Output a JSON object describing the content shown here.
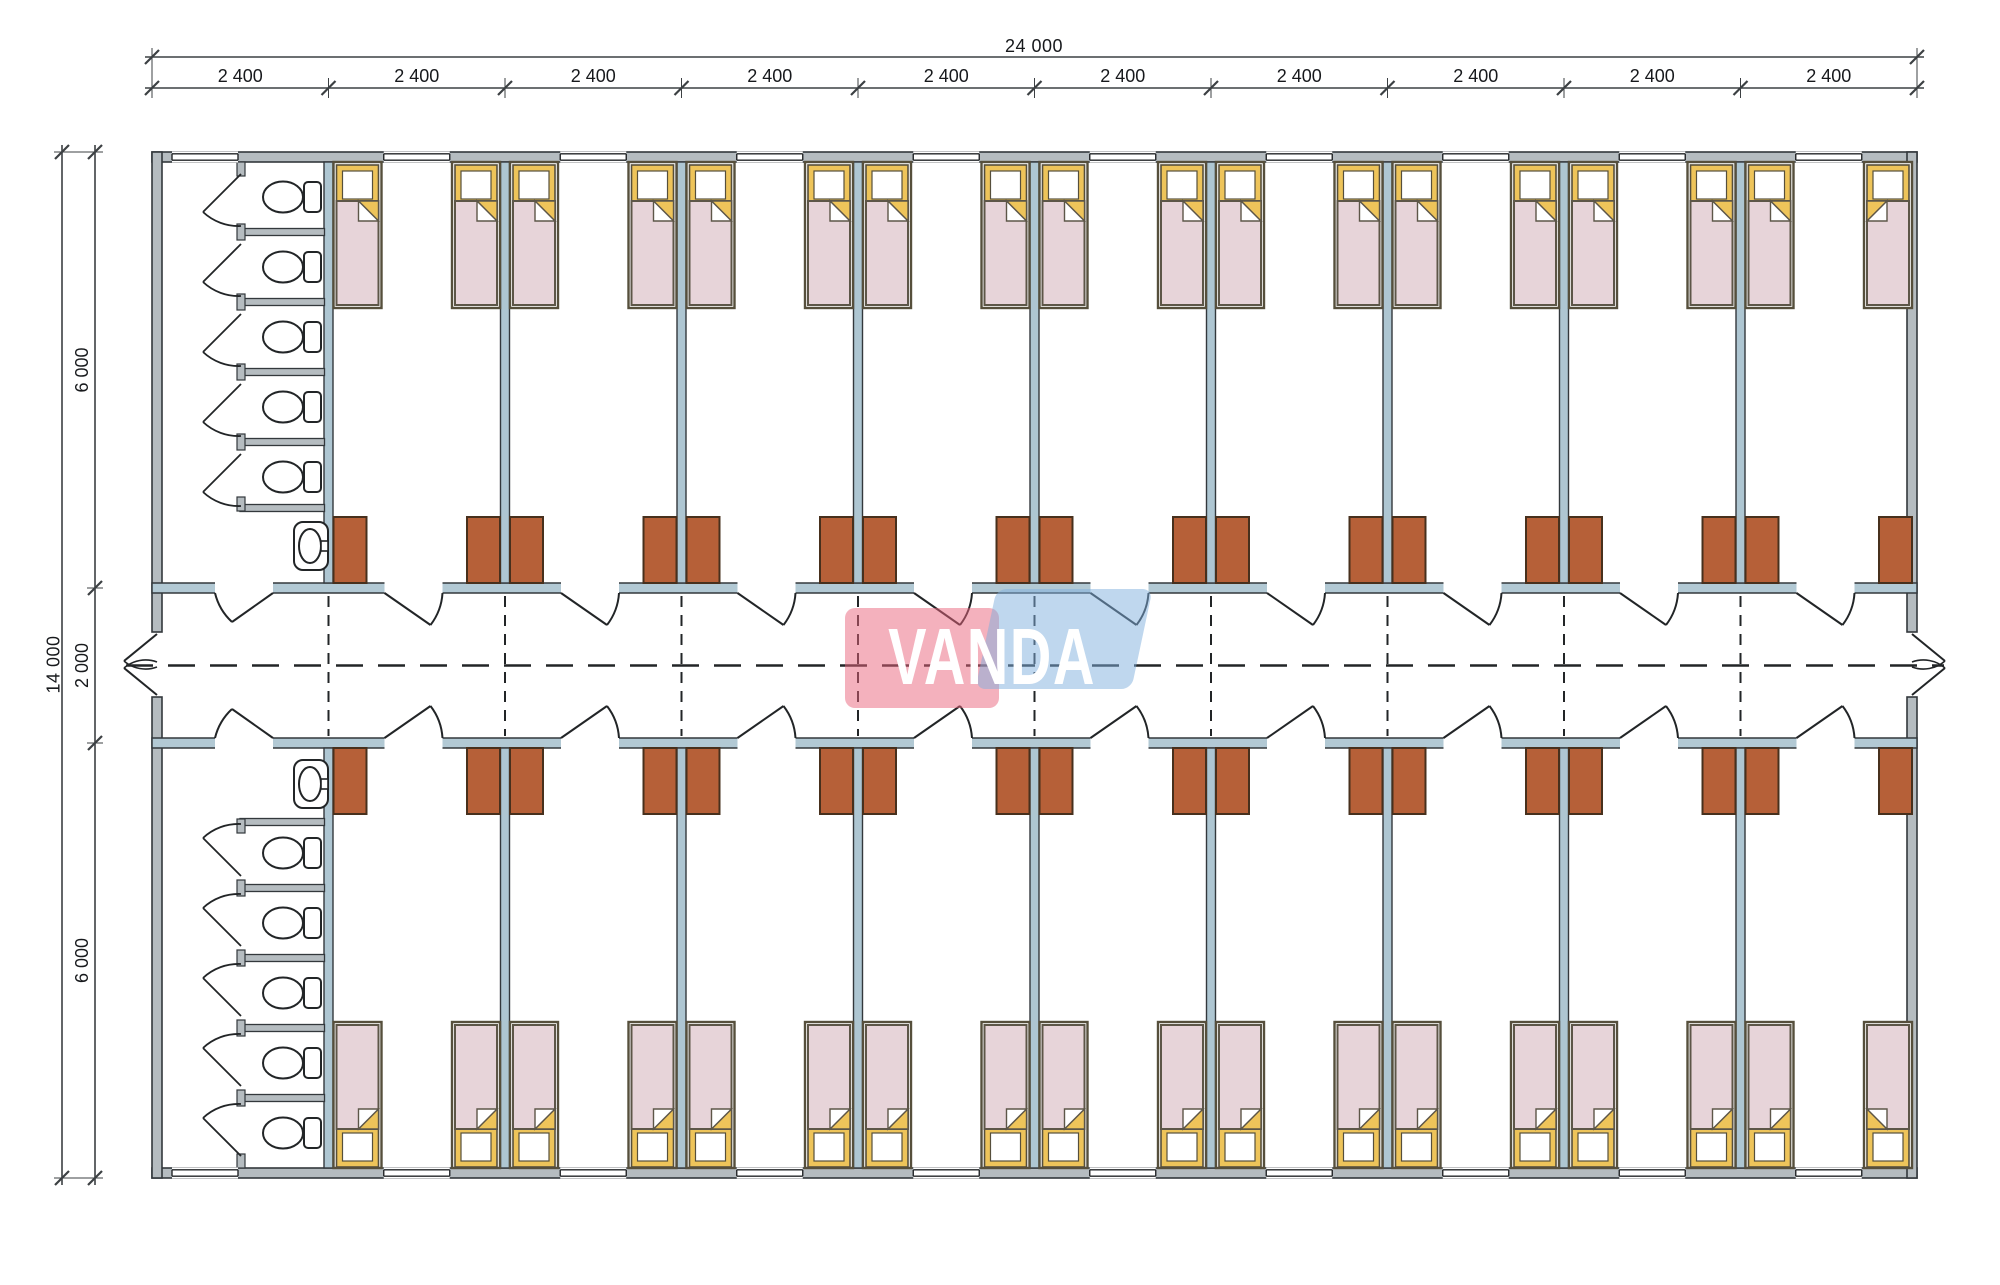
{
  "watermark": {
    "text": "VANDA",
    "pink": "#e9637c",
    "blue": "#80b0dd"
  },
  "dimensions": {
    "top_overall": "24 000",
    "top_segments": [
      "2 400",
      "2 400",
      "2 400",
      "2 400",
      "2 400",
      "2 400",
      "2 400",
      "2 400",
      "2 400",
      "2 400"
    ],
    "left_overall": "14 000",
    "left_segments": [
      "6 000",
      "2 000",
      "6 000"
    ]
  },
  "plan": {
    "modules": 10,
    "module_width_mm": 2400,
    "building_width_mm": 24000,
    "building_depth_mm": 14000,
    "corridor_width_mm": 2000,
    "room_depth_mm": 6000,
    "rows": 2,
    "bedrooms_per_row": 9,
    "beds_per_room": 2,
    "wardrobes_per_room": 2,
    "window_per_room": 1,
    "bathrooms": 2,
    "toilets_per_bathroom": 5,
    "sinks_per_bathroom": 1,
    "corridor_end_doors": 2
  },
  "colors": {
    "wall_fill": "#b5bcc0",
    "corridor_wall_fill": "#b2c9d4",
    "partition_fill": "#aec6d2",
    "wall_line": "#33383c",
    "draw_line": "#222527",
    "bed_frame": "#564f3c",
    "bed_blanket": "#e7d4d9",
    "bed_blanket_line": "#5d5648",
    "bed_yellow": "#eec45a",
    "wardrobe": "#b66038",
    "wardrobe_line": "#47301d",
    "fixture_line": "#222527",
    "dim_line": "#3c4043",
    "dash_line": "#222527"
  }
}
